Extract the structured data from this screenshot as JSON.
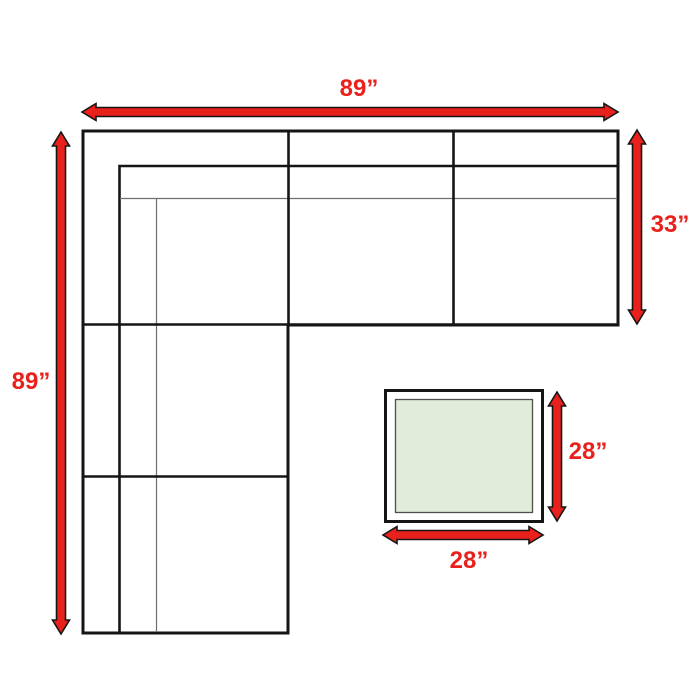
{
  "page": {
    "background": "#ffffff",
    "description": "Top-view dimension diagram of an L-shaped sectional sofa with a matching square table"
  },
  "colors": {
    "arrow-red": "#e8211c",
    "line-black": "#151515",
    "line-thin": "#6f6f6f",
    "table-fill": "#e1ecd9",
    "table-inner-stroke": "#4f4f4f"
  },
  "labels": {
    "sofa_width": "89”",
    "sofa_depth": "89”",
    "chaise_depth": "33”",
    "table_depth": "28”",
    "table_width": "28”"
  }
}
